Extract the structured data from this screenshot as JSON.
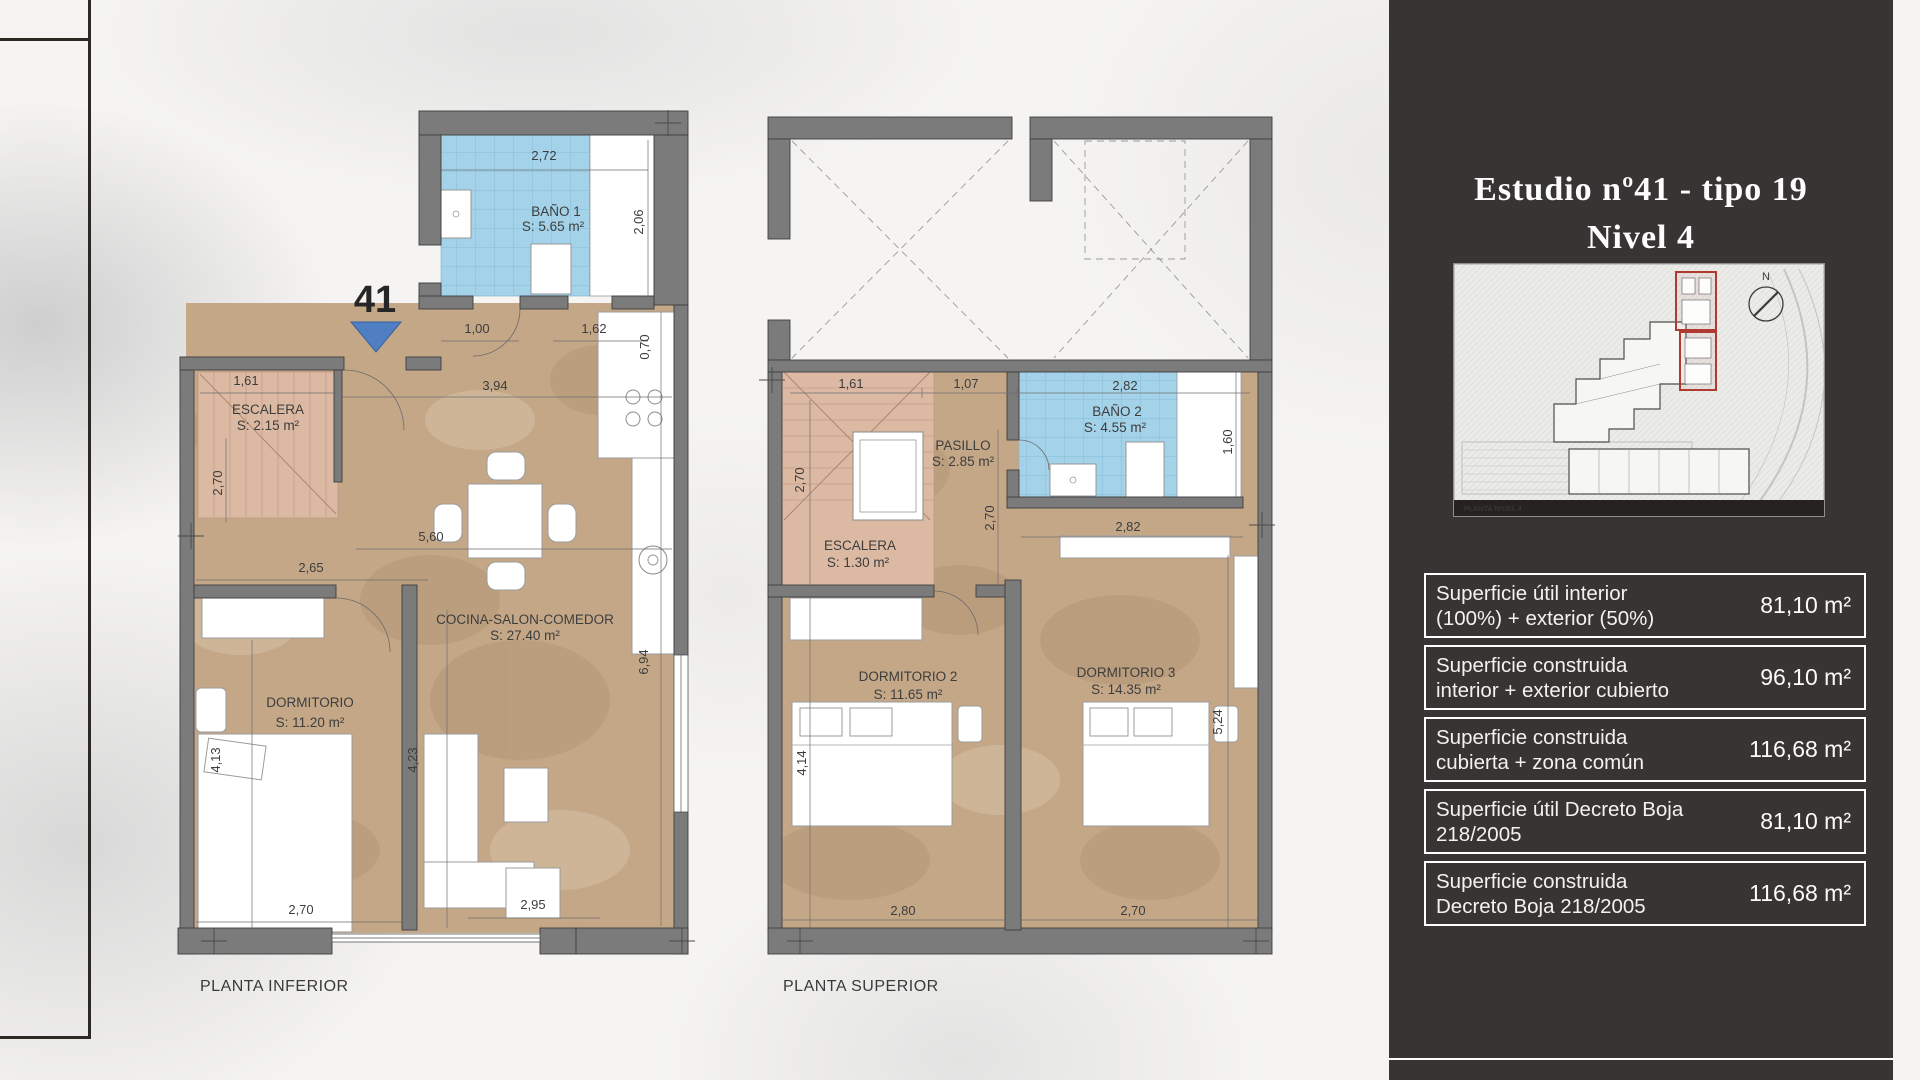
{
  "plans": {
    "inferior": {
      "caption": "PLANTA INFERIOR",
      "unit_marker": "41",
      "rooms": {
        "bano1": {
          "name": "BAÑO 1",
          "area": "S: 5.65 m²"
        },
        "escalera": {
          "name": "ESCALERA",
          "area": "S: 2.15 m²"
        },
        "cocina": {
          "name": "COCINA-SALON-COMEDOR",
          "area": "S: 27.40 m²"
        },
        "dormitorio": {
          "name": "DORMITORIO",
          "area": "S: 11.20 m²"
        }
      },
      "dims": {
        "d272": "2,72",
        "d206": "2,06",
        "d100": "1,00",
        "d162": "1,62",
        "d070": "0,70",
        "d161": "1,61",
        "d394": "3,94",
        "d270a": "2,70",
        "d560": "5,60",
        "d265": "2,65",
        "d413": "4,13",
        "d423": "4,23",
        "d694": "6,94",
        "d270b": "2,70",
        "d295": "2,95"
      }
    },
    "superior": {
      "caption": "PLANTA SUPERIOR",
      "rooms": {
        "pasillo": {
          "name": "PASILLO",
          "area": "S: 2.85 m²"
        },
        "bano2": {
          "name": "BAÑO 2",
          "area": "S: 4.55 m²"
        },
        "escalera": {
          "name": "ESCALERA",
          "area": "S: 1.30 m²"
        },
        "dorm2": {
          "name": "DORMITORIO 2",
          "area": "S: 11.65 m²"
        },
        "dorm3": {
          "name": "DORMITORIO 3",
          "area": "S: 14.35 m²"
        }
      },
      "dims": {
        "d161": "1,61",
        "d107": "1,07",
        "d282a": "2,82",
        "d160": "1,60",
        "d270l": "2,70",
        "d270m": "2,70",
        "d282b": "2,82",
        "d414": "4,14",
        "d524": "5,24",
        "d280": "2,80",
        "d270b": "2,70"
      }
    }
  },
  "panel": {
    "title_line1": "Estudio nº41 - tipo 19",
    "title_line2": "Nivel 4",
    "siteplan": {
      "north_label": "N",
      "caption": "PLANTA NIVEL 4",
      "highlight_color": "#b03a32"
    },
    "table": {
      "rows": [
        {
          "label_line1": "Superficie útil interior",
          "label_line2": "(100%) + exterior (50%)",
          "value": "81,10 m²"
        },
        {
          "label_line1": "Superficie construida",
          "label_line2": "interior + exterior cubierto",
          "value": "96,10 m²"
        },
        {
          "label_line1": "Superficie construida",
          "label_line2": "cubierta + zona común",
          "value": "116,68 m²"
        },
        {
          "label_line1": "Superficie útil Decreto Boja",
          "label_line2": "218/2005",
          "value": "81,10 m²"
        },
        {
          "label_line1": "Superficie construida",
          "label_line2": "Decreto Boja 218/2005",
          "value": "116,68 m²"
        }
      ]
    }
  },
  "colors": {
    "accent_blue": "#4f7fc2",
    "tile_blue": "#a3d2e9",
    "stair_pink": "#dcb9a3",
    "floor_tan": "#c4a787",
    "wall_gray": "#7b7b7b",
    "panel_bg": "#393434",
    "highlight_red": "#b03a32"
  }
}
